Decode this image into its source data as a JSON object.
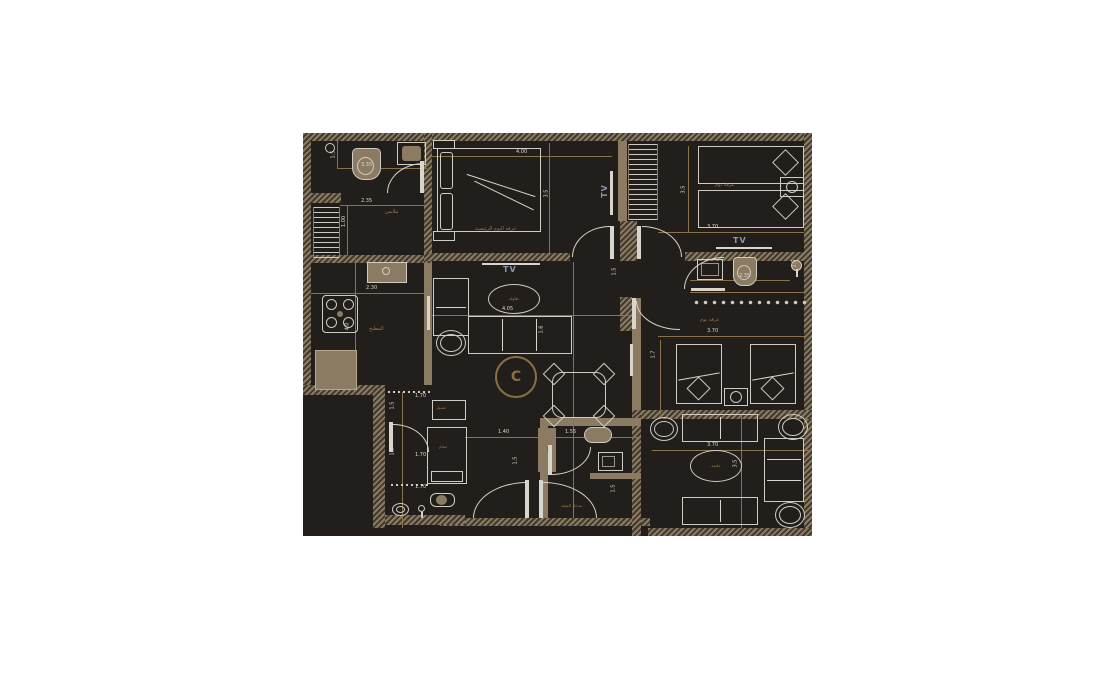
{
  "document": {
    "type": "apartment-floor-plan",
    "background_page": "#ffffff",
    "background_plan": "#211e1b",
    "wall_color": "#8a7b62",
    "dim_line_color": "#8a734a",
    "dim_text_color": "#ddd8cd",
    "label_color": "#9a7a4a",
    "tv_text_color": "#8b97b1"
  },
  "dims": {
    "d335": "3.35",
    "d235": "2.35",
    "d100": "1.00",
    "d400": "4.00",
    "d35": "3.5",
    "d370": "3.70",
    "d15": "1.5",
    "d17": "1.7",
    "d405": "4.05",
    "d16": "1.6",
    "d230": "2.30",
    "d40": "4.0",
    "d170": "1.70",
    "d140": "1.40",
    "d155": "1.55"
  },
  "labels": {
    "dressing": "ملابس",
    "master": "غرفة النوم الرئيسية",
    "bedroom": "غرفة نوم",
    "kitchen": "المطبخ",
    "laundry": "غسيل",
    "bath": "حمام",
    "hall_table": "طاولة",
    "majlis_table": "جلسة",
    "shaft": "ممر",
    "entrance": "مدخل الشقة"
  },
  "tv": "TV",
  "marker": "C"
}
